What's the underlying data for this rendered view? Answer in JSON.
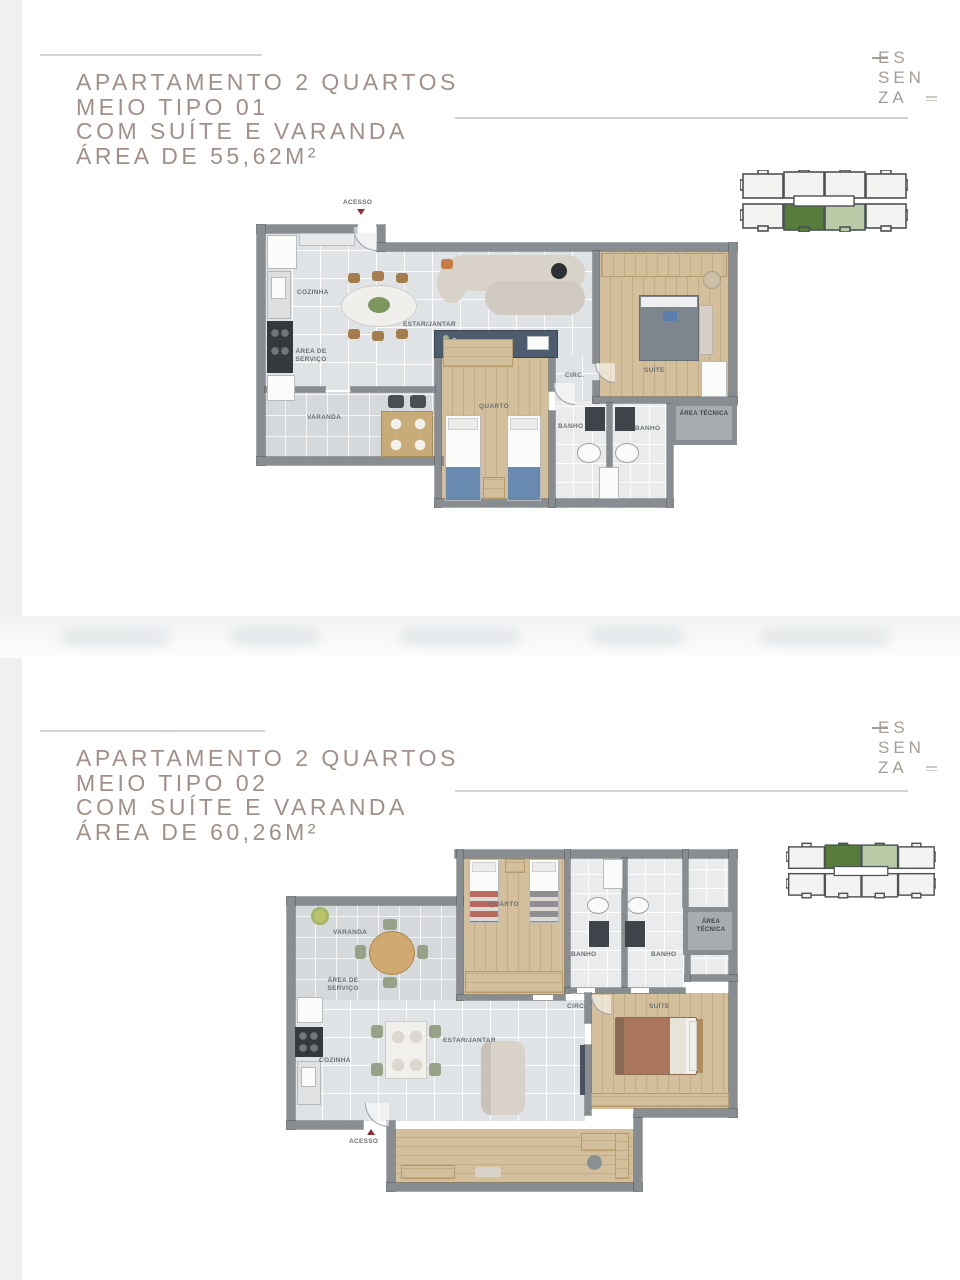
{
  "colors": {
    "title": "#a29088",
    "rule": "#d9d3ce",
    "logo": "#a79c95",
    "wall": "#878d91",
    "wall_dark": "#565c60",
    "tile": "#e0e3e5",
    "tile2": "#e9ebec",
    "balcony": "#d6d9db",
    "wood": "#d3bf9b",
    "tech": "#a7adaf",
    "label": "#6b7073",
    "red": "#8e3038",
    "dark_green": "#587c3b",
    "light_green": "#bac9a6",
    "unit_fill": "#f3f3f1",
    "unit_stroke": "#4d5255",
    "console": "#4e5c6f",
    "strip": "#eef0f1"
  },
  "brand": {
    "line1": "ES",
    "line2": "SEN",
    "line3": "ZA"
  },
  "section1": {
    "title_lines": [
      "APARTAMENTO 2 QUARTOS",
      "MEIO TIPO 01",
      "COM SUÍTE E VARANDA",
      "ÁREA DE 55,62M²"
    ]
  },
  "section2": {
    "title_lines": [
      "APARTAMENTO 2 QUARTOS",
      "MEIO TIPO 02",
      "COM SUÍTE E VARANDA",
      "ÁREA DE 60,26M²"
    ]
  },
  "rooms": {
    "acesso": "ACESSO",
    "cozinha": "COZINHA",
    "estar_jantar": "ESTAR/JANTAR",
    "area_servico": "ÁREA DE SERVIÇO",
    "varanda": "VARANDA",
    "quarto": "QUARTO",
    "banho": "BANHO",
    "circ": "CIRC.",
    "suite": "SUÍTE",
    "area_tecnica": "ÁREA TÉCNICA"
  }
}
